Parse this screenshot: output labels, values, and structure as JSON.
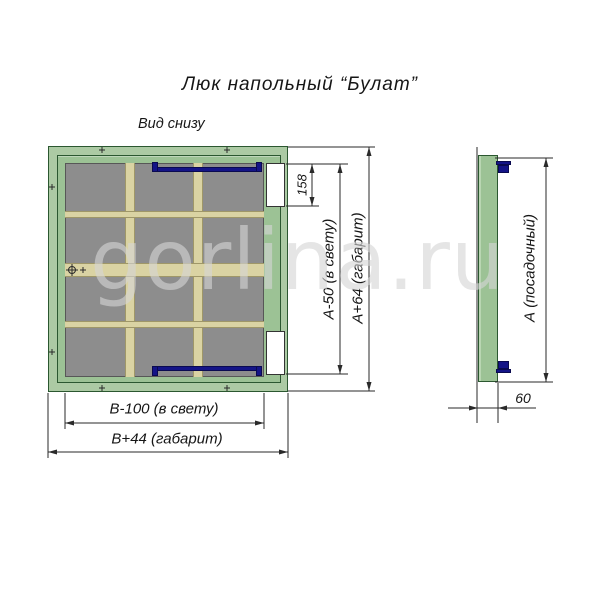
{
  "title": "Люк напольный “Булат”",
  "watermark": "gorlina.ru",
  "bottom_view": {
    "label": "Вид снизу",
    "dims": {
      "cutout_height": "158",
      "clear_height": "А-50 (в свету)",
      "overall_height": "А+64 (габарит)",
      "clear_width": "В-100 (в свету)",
      "overall_width": "В+44 (габарит)"
    }
  },
  "side_view": {
    "dims": {
      "seat_height": "А (посадочный)",
      "depth": "60"
    }
  },
  "colors": {
    "frame_green": "#accaa4",
    "leaf_green": "#9cc295",
    "outline_green": "#2b5730",
    "panel_gray": "#8d8d8d",
    "stiffener_beige": "#dad3a3",
    "latch_blue": "#141487",
    "line_black": "#2a2a2a",
    "watermark_gray": "#d5d5d5"
  }
}
